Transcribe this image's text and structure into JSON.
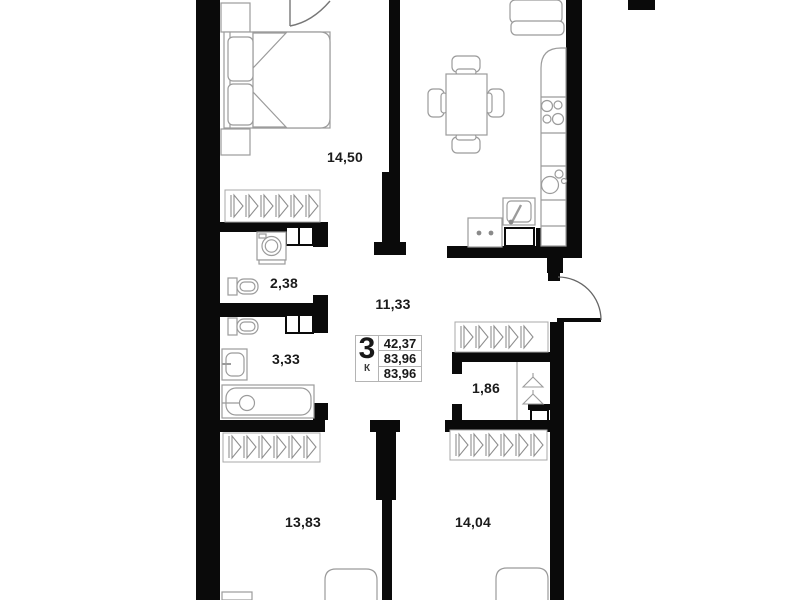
{
  "rooms": [
    {
      "name": "bedroom",
      "area": "14,50"
    },
    {
      "name": "hallway",
      "area": "11,33"
    },
    {
      "name": "wc",
      "area": "2,38"
    },
    {
      "name": "bathroom",
      "area": "3,33"
    },
    {
      "name": "wardrobe",
      "area": "1,86"
    },
    {
      "name": "room-left",
      "area": "13,83"
    },
    {
      "name": "room-right",
      "area": "14,04"
    }
  ],
  "info_box": {
    "rooms_count": "3",
    "rooms_letter": "К",
    "row1": "42,37",
    "row2": "83,96",
    "row3": "83,96"
  },
  "colors": {
    "wall": "#0a0a0a",
    "furniture_line": "#9b9b9b",
    "hatch_line": "#8f8f8f",
    "background": "#ffffff",
    "text": "#1b1b1b",
    "info_border": "#b4b4b4"
  }
}
